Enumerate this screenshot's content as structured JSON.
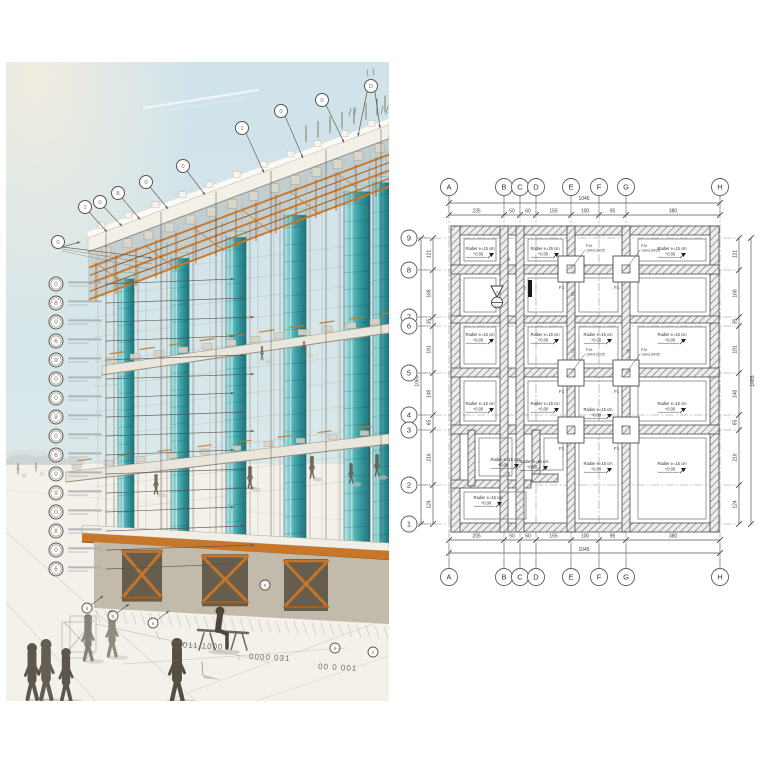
{
  "panels": {
    "illustration": {
      "description": "construction-site illustration: glass curtain-wall building under construction with scaffolding and annotation callouts",
      "marker_glyphs_left": [
        "0",
        "8",
        "0",
        "6",
        "9",
        "0",
        "0",
        "8",
        "0",
        "6",
        "0",
        "9",
        "0",
        "8",
        "0",
        "6"
      ],
      "marker_glyphs_top": [
        "0",
        "1",
        "0",
        "8",
        "0",
        "0",
        "1",
        "0",
        "0",
        "D"
      ],
      "marker_glyphs_bottom": [
        "8",
        "0",
        "6",
        "0",
        "9",
        "0"
      ],
      "sketch_numbers": [
        "0 011 1000",
        "0000 031",
        "00 0 001"
      ],
      "colors": {
        "sky": "#cfe2ea",
        "glass_teal": "#2f9da3",
        "scaffold_orange": "#c8772a",
        "slab_white": "#f3f1e9",
        "sketch_gray": "#6a645c"
      }
    },
    "plan": {
      "grid_columns": [
        "A",
        "B",
        "C",
        "D",
        "E",
        "F",
        "G",
        "H"
      ],
      "grid_rows": [
        "9",
        "8",
        "7",
        "6",
        "5",
        "4",
        "3",
        "2",
        "1"
      ],
      "overall_width": "1045",
      "overall_height": "1065",
      "dims_top": [
        "235",
        "50",
        "60",
        "155",
        "100",
        "95",
        "380"
      ],
      "dims_bottom": [
        "205",
        "50",
        "60",
        "155",
        "100",
        "95",
        "380"
      ],
      "dims_side": [
        "121",
        "168",
        "35",
        "191",
        "148",
        "65",
        "216",
        "124"
      ],
      "room_note_line1": "Radier e=15 cm",
      "room_note_line2": "+0.00",
      "footing_tag": "F1",
      "footing_note_line1": "P.M.",
      "footing_note_line2": "130x130/35",
      "minor_dims": [
        "50",
        "15",
        "50",
        "15",
        "15",
        "50"
      ],
      "section_marker": {
        "triangle_label": "2",
        "circle_label": "P-0"
      },
      "line_color": "#4a4a4e"
    }
  }
}
